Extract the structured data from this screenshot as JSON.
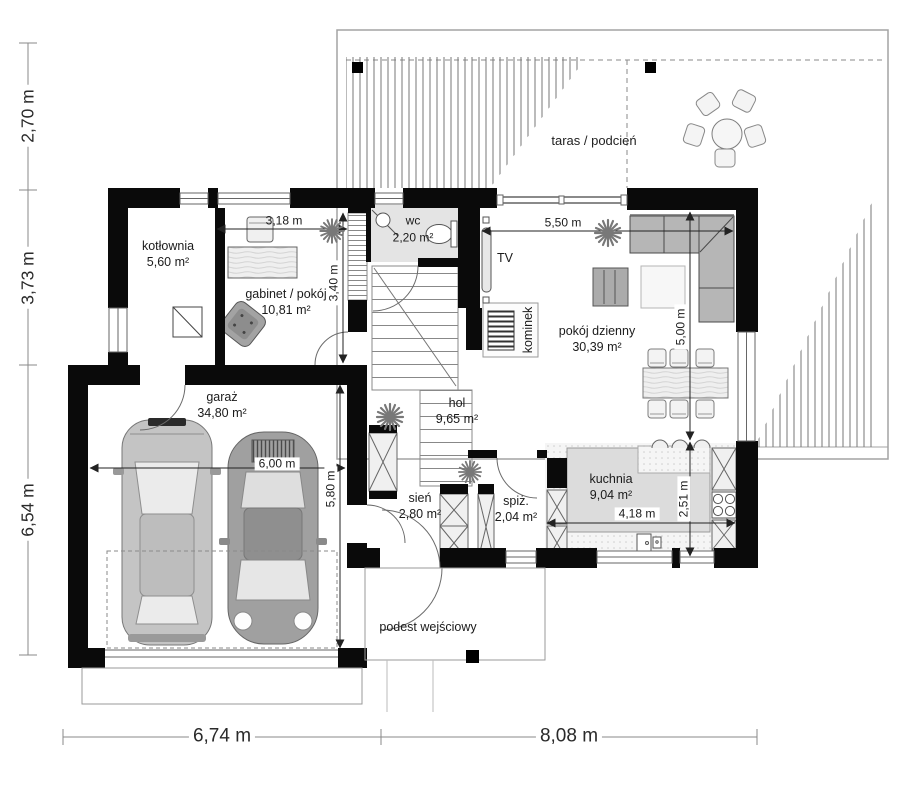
{
  "rooms": {
    "kotlownia": {
      "name": "kotłownia",
      "area": "5,60 m²"
    },
    "gabinet": {
      "name": "gabinet / pokój",
      "area": "10,81 m²"
    },
    "wc": {
      "name": "wc",
      "area": "2,20 m²"
    },
    "garaz": {
      "name": "garaż",
      "area": "34,80 m²"
    },
    "hol": {
      "name": "hol",
      "area": "9,65 m²"
    },
    "sien": {
      "name": "sień",
      "area": "2,80 m²"
    },
    "spiz": {
      "name": "spiż.",
      "area": "2,04 m²"
    },
    "kuchnia": {
      "name": "kuchnia",
      "area": "9,04 m²"
    },
    "pokoj_dzienny": {
      "name": "pokój dzienny",
      "area": "30,39 m²"
    }
  },
  "zones": {
    "taras": "taras / podcień",
    "podest": "podest wejściowy",
    "kominek": "kominek",
    "tv": "TV"
  },
  "dimensions": {
    "left": [
      "2,70 m",
      "3,73 m",
      "6,54 m"
    ],
    "bottom": [
      "6,74 m",
      "8,08 m"
    ],
    "interior": {
      "gabinet_width": "3,18 m",
      "gabinet_depth": "3,40 m",
      "living_width": "5,50 m",
      "living_depth": "5,00 m",
      "garage_width": "6,00 m",
      "garage_depth": "5,80 m",
      "kitchen_width": "4,18 m",
      "kitchen_depth": "2,51 m"
    }
  },
  "colors": {
    "wall": "#0a0a0a",
    "dimension_line": "#222222",
    "wet_room_floor": "#e4e4e4",
    "counter": "#dcdcdc",
    "sofa": "#b6b6b6"
  }
}
